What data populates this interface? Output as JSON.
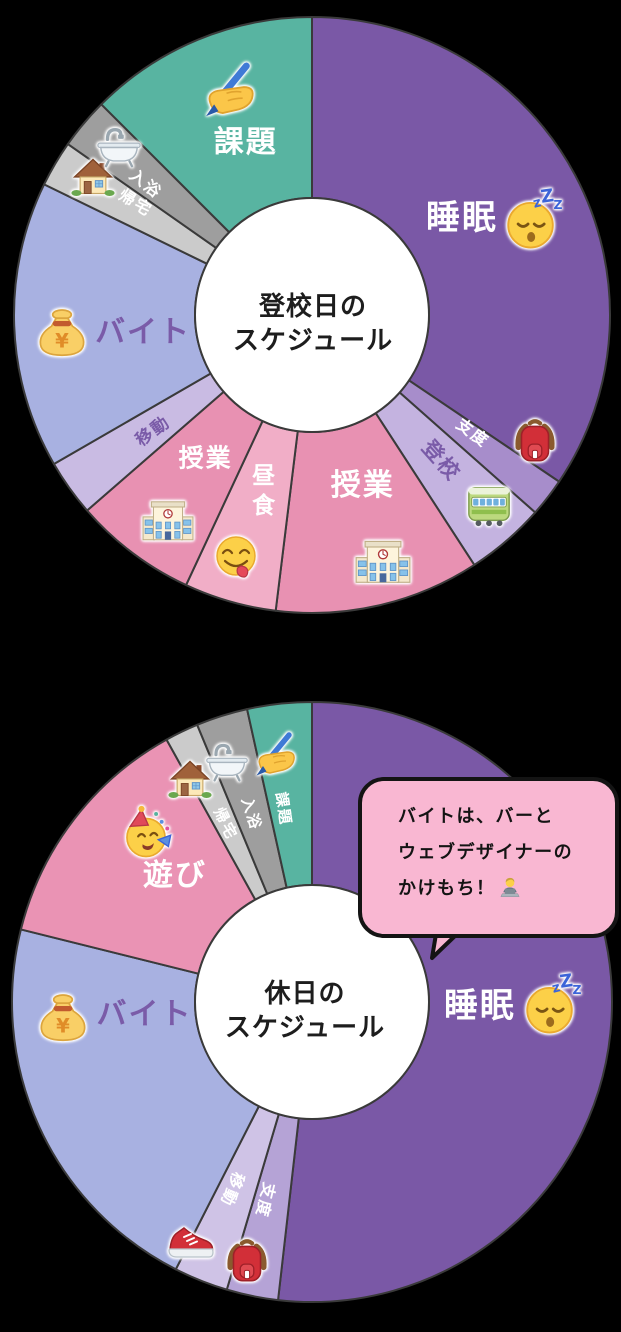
{
  "background": "#000000",
  "stroke_color": "#3a3a3a",
  "hole_color": "#ffffff",
  "label_purple": "#7a5ba8",
  "chart_data": [
    {
      "type": "pie",
      "variant": "donut",
      "title": "登校日のスケジュール",
      "categories": [
        "睡眠",
        "支度",
        "登校",
        "授業",
        "昼食",
        "授業",
        "移動",
        "バイト",
        "帰宅",
        "入浴",
        "課題"
      ],
      "span_degrees": [
        124,
        7.5,
        15.5,
        40,
        18,
        24,
        11,
        57,
        9,
        10,
        44
      ],
      "approx_hours": [
        8.25,
        0.5,
        1,
        2.75,
        1.25,
        1.5,
        0.75,
        3.75,
        0.5,
        0.75,
        3
      ],
      "start_at_top": true,
      "direction": "clockwise",
      "legend": "labels inside slices with emoji stickers"
    },
    {
      "type": "pie",
      "variant": "donut",
      "title": "休日のスケジュール",
      "categories": [
        "睡眠",
        "支度",
        "移動",
        "バイト",
        "遊び",
        "帰宅",
        "入浴",
        "課題"
      ],
      "span_degrees": [
        186.5,
        10,
        10.5,
        77,
        47,
        6.5,
        10,
        12.5
      ],
      "approx_hours": [
        12.5,
        0.75,
        0.75,
        5,
        3,
        0.5,
        0.75,
        0.75
      ],
      "start_at_top": true,
      "direction": "clockwise",
      "legend": "labels inside slices with emoji stickers"
    }
  ],
  "charts": [
    {
      "title_lines": [
        "登校日の",
        "スケジュール"
      ],
      "cx": 312,
      "cy": 315,
      "outer_r": 298,
      "inner_r": 117,
      "title_x": 313,
      "title_y": 324,
      "segments": [
        {
          "label": "睡眠",
          "color": "#7a58a6",
          "a0": 0,
          "a1": 124,
          "la": 57,
          "lr": 0.6,
          "rot": 0,
          "lc": "#ffffff",
          "ls": 34,
          "icon": "sleeping-face-icon",
          "ia": 66.5,
          "ir": 0.81,
          "is": 62
        },
        {
          "label": "支度",
          "color": "#a78dcb",
          "a0": 124,
          "a1": 131.5,
          "la": 126.5,
          "lr": 0.67,
          "rot": 36.5,
          "lc": "#ffffff",
          "ls": 16,
          "icon": "backpack-icon",
          "ia": 119.5,
          "ir": 0.86,
          "is": 52
        },
        {
          "label": "登校",
          "color": "#c4b3e0",
          "a0": 131.5,
          "a1": 147,
          "la": 138.5,
          "lr": 0.655,
          "rot": 48.5,
          "lc": "#7a5ba8",
          "ls": 21,
          "icon": "train-icon",
          "ia": 137,
          "ir": 0.87,
          "is": 48
        },
        {
          "label": "授業",
          "color": "#e891b2",
          "a0": 147,
          "a1": 187,
          "la": 163.5,
          "lr": 0.6,
          "rot": 0,
          "lc": "#ffffff",
          "ls": 30,
          "icon": "school-icon",
          "ia": 164,
          "ir": 0.86,
          "is": 56
        },
        {
          "label": "昼食",
          "color": "#f1aec7",
          "a0": 187,
          "a1": 205,
          "la": 196,
          "lr": 0.62,
          "rot": 0,
          "lc": "#ffffff",
          "ls": 23,
          "stack": true,
          "icon": "yum-face-icon",
          "ia": 197.5,
          "ir": 0.85,
          "is": 50
        },
        {
          "label": "授業",
          "color": "#e891b2",
          "a0": 205,
          "a1": 229,
          "la": 216.5,
          "lr": 0.6,
          "rot": 0,
          "lc": "#ffffff",
          "ls": 25,
          "icon": "school-icon",
          "ia": 215,
          "ir": 0.84,
          "is": 52
        },
        {
          "label": "移動",
          "color": "#c9bbe3",
          "a0": 229,
          "a1": 240,
          "la": 234,
          "lr": 0.66,
          "rot": -36,
          "lc": "#7a5ba8",
          "ls": 17
        },
        {
          "label": "バイト",
          "color": "#a8b1e1",
          "a0": 240,
          "a1": 296,
          "la": 264,
          "lr": 0.57,
          "rot": 0,
          "lc": "#7a5ba8",
          "ls": 30,
          "icon": "money-bag-icon",
          "ia": 266,
          "ir": 0.84,
          "is": 58
        },
        {
          "label": "帰宅",
          "color": "#cbcbcb",
          "a0": 296,
          "a1": 305,
          "la": 302,
          "lr": 0.7,
          "rot": 32,
          "lc": "#ffffff",
          "ls": 16,
          "icon": "house-icon",
          "ia": 302.5,
          "ir": 0.87,
          "is": 46
        },
        {
          "label": "入浴",
          "color": "#9e9e9e",
          "a0": 305,
          "a1": 315,
          "la": 308,
          "lr": 0.71,
          "rot": 38,
          "lc": "#ffffff",
          "ls": 16,
          "icon": "bathtub-icon",
          "ia": 311,
          "ir": 0.86,
          "is": 48
        },
        {
          "label": "課題",
          "color": "#58b4a1",
          "a0": 315,
          "a1": 360,
          "la": 339,
          "lr": 0.62,
          "rot": 0,
          "lc": "#ffffff",
          "ls": 30,
          "icon": "writing-hand-icon",
          "ia": 339.5,
          "ir": 0.8,
          "is": 62
        }
      ]
    },
    {
      "title_lines": [
        "休日の",
        "スケジュール"
      ],
      "cx": 312,
      "cy": 1002,
      "outer_r": 300,
      "inner_r": 117,
      "title_x": 305,
      "title_y": 1011,
      "segments": [
        {
          "label": "睡眠",
          "color": "#7a58a6",
          "a0": 0,
          "a1": 186.5,
          "la": 91.5,
          "lr": 0.56,
          "rot": 0,
          "lc": "#ffffff",
          "ls": 34,
          "icon": "sleeping-face-icon",
          "ia": 90.5,
          "ir": 0.8,
          "is": 62
        },
        {
          "label": "支度",
          "color": "#b5a3d6",
          "a0": 186.5,
          "a1": 196.5,
          "la": 193.5,
          "lr": 0.68,
          "rot": 103.5,
          "lc": "#ffffff",
          "ls": 16,
          "icon": "backpack-icon",
          "ia": 194,
          "ir": 0.89,
          "is": 52
        },
        {
          "label": "移動",
          "color": "#cfc3e6",
          "a0": 196.5,
          "a1": 207,
          "la": 203.5,
          "lr": 0.68,
          "rot": 113.5,
          "lc": "#ffffff",
          "ls": 16,
          "icon": "sneaker-icon",
          "ia": 207,
          "ir": 0.885,
          "is": 50
        },
        {
          "label": "バイト",
          "color": "#a8b1e1",
          "a0": 207,
          "a1": 284,
          "la": 265.5,
          "lr": 0.56,
          "rot": 0,
          "lc": "#7a5ba8",
          "ls": 30,
          "icon": "money-bag-icon",
          "ia": 266.5,
          "ir": 0.83,
          "is": 58
        },
        {
          "label": "遊び",
          "color": "#ea93b4",
          "a0": 284,
          "a1": 331,
          "la": 312.5,
          "lr": 0.62,
          "rot": 0,
          "lc": "#ffffff",
          "ls": 30,
          "icon": "party-face-icon",
          "ia": 315.5,
          "ir": 0.79,
          "is": 56
        },
        {
          "label": "帰宅",
          "color": "#cbcbcb",
          "a0": 331,
          "a1": 337.5,
          "la": 334,
          "lr": 0.66,
          "rot": 64,
          "lc": "#ffffff",
          "ls": 15,
          "icon": "house-icon",
          "ia": 331.5,
          "ir": 0.85,
          "is": 46
        },
        {
          "label": "入浴",
          "color": "#9e9e9e",
          "a0": 337.5,
          "a1": 347.5,
          "la": 342,
          "lr": 0.66,
          "rot": 72,
          "lc": "#ffffff",
          "ls": 15,
          "icon": "bathtub-icon",
          "ia": 340.5,
          "ir": 0.85,
          "is": 46
        },
        {
          "label": "課題",
          "color": "#58b4a1",
          "a0": 347.5,
          "a1": 360,
          "la": 351.5,
          "lr": 0.65,
          "rot": 81.5,
          "lc": "#ffffff",
          "ls": 15,
          "icon": "writing-hand-icon",
          "ia": 351.5,
          "ir": 0.83,
          "is": 50
        }
      ]
    }
  ],
  "speech_bubble": {
    "lines": [
      "バイトは、バーと",
      "ウェブデザイナーの",
      "かけもち！"
    ],
    "icon": "technologist-icon",
    "fill": "#f9b7d2",
    "border": "#141414",
    "text_color": "#141414"
  }
}
